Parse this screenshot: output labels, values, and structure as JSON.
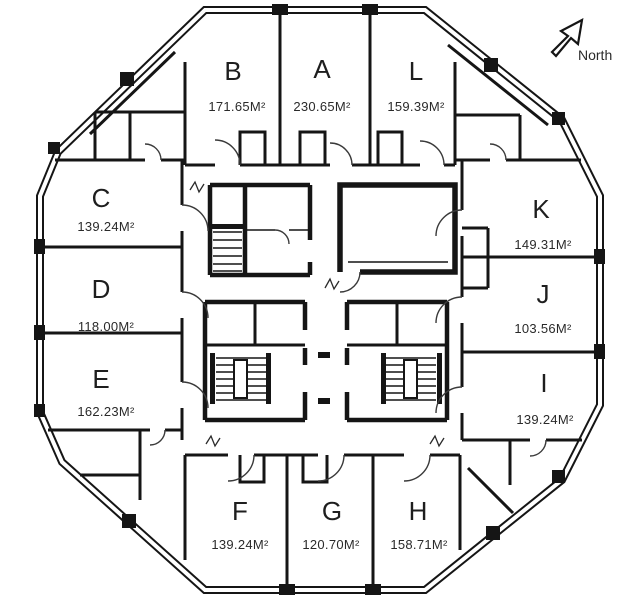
{
  "title": "Tower floor plan",
  "north": {
    "label": "North"
  },
  "units": [
    {
      "id": "B",
      "area": "171.65M²"
    },
    {
      "id": "A",
      "area": "230.65M²"
    },
    {
      "id": "L",
      "area": "159.39M²"
    },
    {
      "id": "C",
      "area": "139.24M²"
    },
    {
      "id": "D",
      "area": "118.00M²"
    },
    {
      "id": "E",
      "area": "162.23M²"
    },
    {
      "id": "F",
      "area": "139.24M²"
    },
    {
      "id": "G",
      "area": "120.70M²"
    },
    {
      "id": "H",
      "area": "158.71M²"
    },
    {
      "id": "K",
      "area": "149.31M²"
    },
    {
      "id": "J",
      "area": "103.56M²"
    },
    {
      "id": "I",
      "area": "139.24M²"
    }
  ],
  "colors": {
    "wall": "#151515",
    "background": "#ffffff",
    "text": "#1e1e1e"
  }
}
